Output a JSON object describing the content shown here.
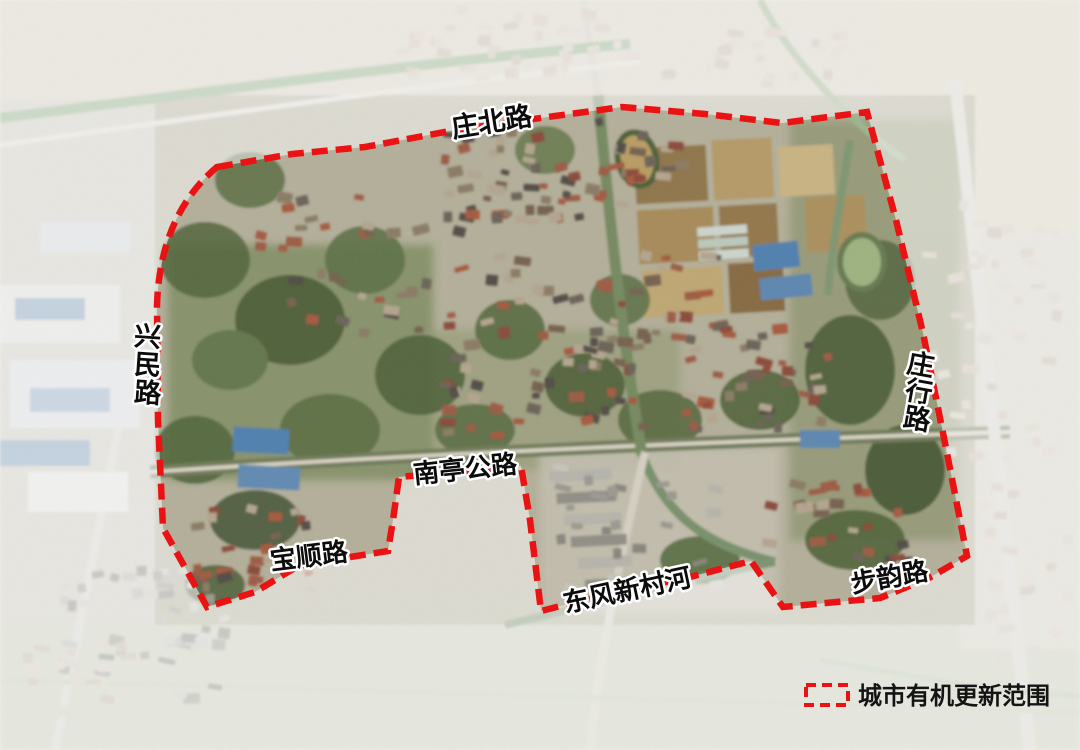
{
  "road_labels": {
    "zhuangbei": {
      "text": "庄北路"
    },
    "xingmin": {
      "text": "兴民路",
      "chars": [
        "兴",
        "民",
        "路"
      ]
    },
    "zhuangxing": {
      "text": "庄行路",
      "chars": [
        "庄",
        "行",
        "路"
      ]
    },
    "nanting": {
      "text": "南亭公路"
    },
    "baoshun": {
      "text": "宝顺路"
    },
    "dongfeng_river": {
      "text": "东风新村河"
    },
    "buyun": {
      "text": "步韵路"
    }
  },
  "legend": {
    "boundary_label": "城市有机更新范围"
  },
  "colors": {
    "boundary": "#ea1213",
    "label_fill": "#0c0c0c",
    "label_outline": "#ffffff"
  }
}
